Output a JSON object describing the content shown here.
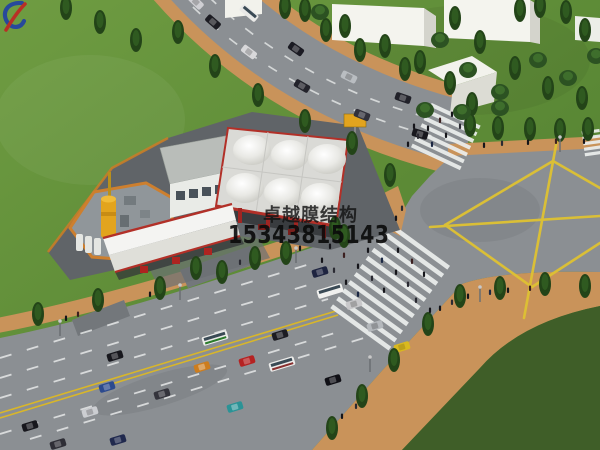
{
  "meta": {
    "type": "3d-architectural-rendering",
    "description": "Aerial rendering of a membrane-structure gas station at a road intersection with yellow junction grid, zebra crossings, tree-lined sidewalks, vehicles and white block buildings"
  },
  "watermark": {
    "company_name": "卓越膜结构",
    "phone_number": "15343815143",
    "text_color": "#141414",
    "logo_blue": "#1e3ea8",
    "logo_red": "#c32222"
  },
  "scene": {
    "elements": [
      "grass",
      "tree-lined top road",
      "main multi-lane road",
      "intersection with yellow diamond grid marking",
      "zebra crosswalks with pedestrians",
      "gas station with white membrane canopies and red trim",
      "equipment yard with yellow tank",
      "white block buildings"
    ],
    "palette": {
      "grass_light": "#6d9a40",
      "grass_dark": "#3f5e28",
      "road_gray": "#8b8f93",
      "sidewalk_tan": "#c9935a",
      "marking_yellow": "#dfc232",
      "lane_white": "#e6e8e8",
      "canopy_white": "#efefec",
      "canopy_trim_red": "#b23028",
      "tank_yellow": "#e2a41e",
      "tree_green": "#234418"
    }
  }
}
